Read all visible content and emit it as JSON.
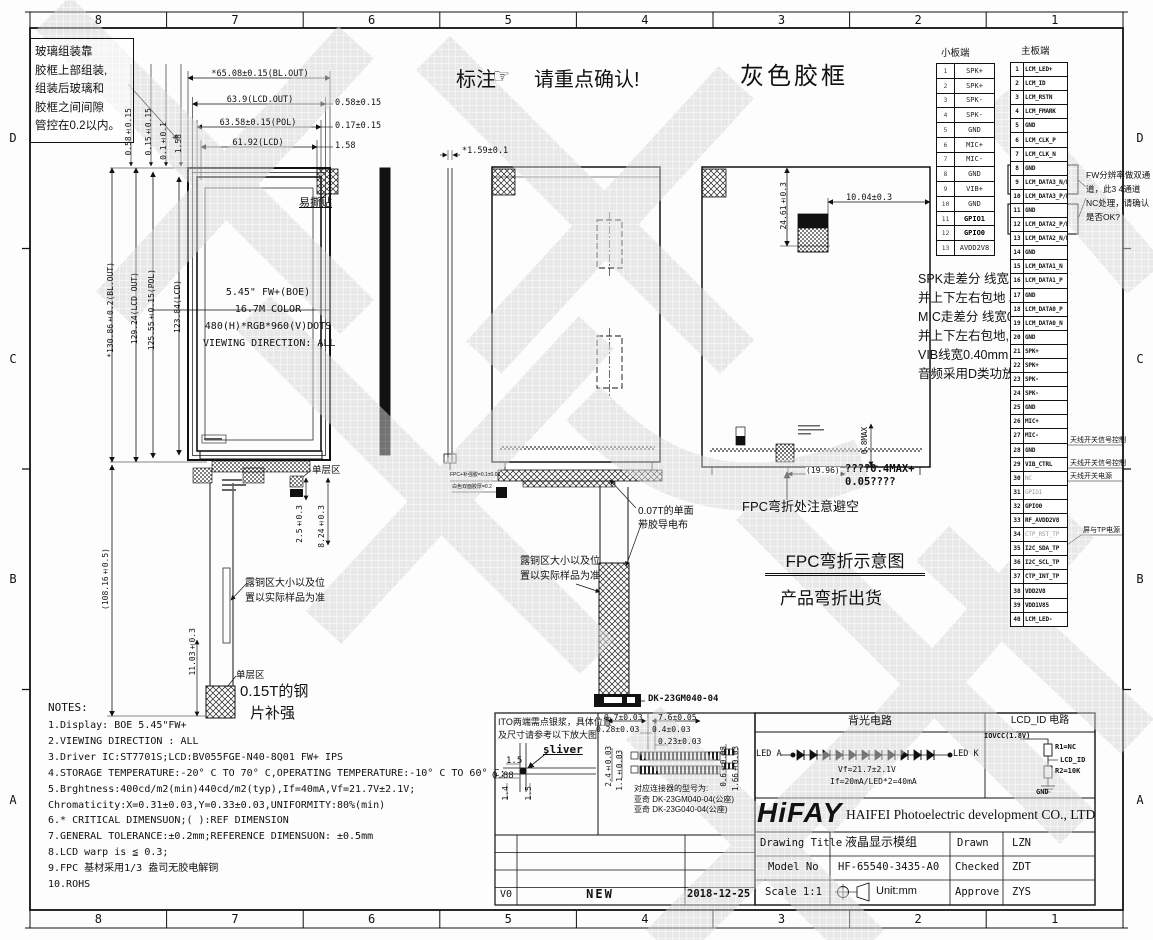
{
  "colors": {
    "line": "#111111",
    "watermark": "#d4d4d4"
  },
  "border": {
    "cols": [
      "8",
      "7",
      "6",
      "5",
      "4",
      "3",
      "2",
      "1"
    ],
    "rows": [
      "D",
      "C",
      "B",
      "A"
    ]
  },
  "header": {
    "glass_note_lines": [
      "玻璃组装靠",
      "胶框上部组装,",
      "组装后玻璃和",
      "胶框之间间隙",
      "管控在0.2以内。"
    ],
    "annotation_label": "标注",
    "hand_icon": "☞",
    "confirm_label": "请重点确认!",
    "gray_frame_label": "灰色胶框"
  },
  "front_view": {
    "dims_top": [
      "*65.08±0.15(BL.OUT)",
      "63.9(LCD.OUT)",
      "63.58±0.15(POL)",
      "61.92(LCD)"
    ],
    "dims_top_right": [
      "0.58±0.15",
      "0.17±0.15",
      "1.58"
    ],
    "dims_top_small": [
      "0.58±0.15",
      "0.15±0.15",
      "0.1±0.1",
      "1.58"
    ],
    "dims_left": [
      "*130.86±0.2(BL.OUT)",
      "129.24(LCD OUT)",
      "125.55±0.15(POL)",
      "123.84(LCD)"
    ],
    "easy_tear_label": "易撕贴",
    "panel_lines": [
      "5.45\" FW+(BOE)",
      "16.7M COLOR",
      "480(H)*RGB*960(V)DOTS",
      "VIEWING DIRECTION: ALL"
    ],
    "dim_tail_total": "(108.16±0.5)",
    "dim_tail_1": "2.5±0.3",
    "dim_tail_2": "8.24±0.3",
    "dim_tail_3": "11.03±0.3",
    "single_layer_label_1": "单层区",
    "single_layer_label_2": "单层区",
    "copper_note_lines": [
      "露铜区大小以及位",
      "置以实际样品为准"
    ],
    "steel_note_line1": "0.15T的钢",
    "steel_note_line2": "片补强"
  },
  "side_view": {
    "dim_thickness": "*1.59±0.1"
  },
  "back_view": {
    "cloth_note_lines": [
      "0.07T的单面",
      "带胶导电布"
    ],
    "copper_note_lines": [
      "露铜区大小以及位",
      "置以实际样品为准"
    ],
    "stack_note_line1": "FPC+补强胶=0.1±0.03",
    "stack_note_line2": "白色双面胶厚=0.2",
    "connector_label": "DK-23GM040-04"
  },
  "frame_view": {
    "dim_height": "24.61±0.3",
    "dim_width": "10.04±0.3",
    "dim_gap": "(19.96)",
    "dim_max": "0.8MAX",
    "foam_note_line1": "????0.4MAX+",
    "foam_note_line2": "0.05????",
    "bend_note": "FPC弯折处注意避空",
    "bend_title": "FPC弯折示意图",
    "bend_subtitle": "产品弯折出货"
  },
  "small_board": {
    "title": "小板端",
    "rows": [
      {
        "pin": "1",
        "signal": "SPK+"
      },
      {
        "pin": "2",
        "signal": "SPK+"
      },
      {
        "pin": "3",
        "signal": "SPK-"
      },
      {
        "pin": "4",
        "signal": "SPK-"
      },
      {
        "pin": "5",
        "signal": "GND"
      },
      {
        "pin": "6",
        "signal": "MIC+"
      },
      {
        "pin": "7",
        "signal": "MIC-"
      },
      {
        "pin": "8",
        "signal": "GND"
      },
      {
        "pin": "9",
        "signal": "VIB+"
      },
      {
        "pin": "10",
        "signal": "GND"
      },
      {
        "pin": "11",
        "signal": "GPIO1"
      },
      {
        "pin": "12",
        "signal": "GPIO0"
      },
      {
        "pin": "13",
        "signal": "AVDD2V8"
      }
    ]
  },
  "main_board": {
    "title": "主板端",
    "rows": [
      {
        "pin": "1",
        "signal": "LCM_LED+"
      },
      {
        "pin": "2",
        "signal": "LCM_ID"
      },
      {
        "pin": "3",
        "signal": "LCM_RSTN"
      },
      {
        "pin": "4",
        "signal": "LCM_FMARK"
      },
      {
        "pin": "5",
        "signal": "GND"
      },
      {
        "pin": "6",
        "signal": "LCM_CLK_P"
      },
      {
        "pin": "7",
        "signal": "LCM_CLK_N"
      },
      {
        "pin": "8",
        "signal": "GND"
      },
      {
        "pin": "9",
        "signal": "LCM_DATA3_N/NC"
      },
      {
        "pin": "10",
        "signal": "LCM_DATA3_P/NC"
      },
      {
        "pin": "11",
        "signal": "GND"
      },
      {
        "pin": "12",
        "signal": "LCM_DATA2_P/NC"
      },
      {
        "pin": "13",
        "signal": "LCM_DATA2_N/NC"
      },
      {
        "pin": "14",
        "signal": "GND"
      },
      {
        "pin": "15",
        "signal": "LCM_DATA1_N"
      },
      {
        "pin": "16",
        "signal": "LCM_DATA1_P"
      },
      {
        "pin": "17",
        "signal": "GND"
      },
      {
        "pin": "18",
        "signal": "LCM_DATA0_P"
      },
      {
        "pin": "19",
        "signal": "LCM_DATA0_N"
      },
      {
        "pin": "20",
        "signal": "GND"
      },
      {
        "pin": "21",
        "signal": "SPK+"
      },
      {
        "pin": "22",
        "signal": "SPK+"
      },
      {
        "pin": "23",
        "signal": "SPK-"
      },
      {
        "pin": "24",
        "signal": "SPK-"
      },
      {
        "pin": "25",
        "signal": "GND"
      },
      {
        "pin": "26",
        "signal": "MIC+"
      },
      {
        "pin": "27",
        "signal": "MIC-"
      },
      {
        "pin": "28",
        "signal": "GND"
      },
      {
        "pin": "29",
        "signal": "VIB_CTRL"
      },
      {
        "pin": "30",
        "signal": "NC"
      },
      {
        "pin": "31",
        "signal": "GPIO1"
      },
      {
        "pin": "32",
        "signal": "GPIO0"
      },
      {
        "pin": "33",
        "signal": "RF_AVDD2V8"
      },
      {
        "pin": "34",
        "signal": "CTP_RST_TP"
      },
      {
        "pin": "35",
        "signal": "I2C_SDA_TP"
      },
      {
        "pin": "36",
        "signal": "I2C_SCL_TP"
      },
      {
        "pin": "37",
        "signal": "CTP_INT_TP"
      },
      {
        "pin": "38",
        "signal": "VDD2V8"
      },
      {
        "pin": "39",
        "signal": "VDD1V85"
      },
      {
        "pin": "40",
        "signal": "LCM_LED-"
      }
    ]
  },
  "fw_note_lines": [
    "FW分辨率做双通",
    "道，此3 4通道",
    "NC处理，请确认",
    "是否OK?"
  ],
  "routing_note_lines": [
    "SPK走差分 线宽1.0mm",
    "并上下左右包地 。",
    "MIC走差分 线宽0.30mm",
    "并上下左右包地,",
    "VIB线宽0.40mm",
    "音频采用D类功放"
  ],
  "pin_notes": {
    "ant1": "天线开关信号控制",
    "ant2": "天线开关信号控制",
    "ant_pwr": "天线开关电源",
    "tp_pwr": "屏与TP电源"
  },
  "notes": {
    "title": "NOTES:",
    "lines": [
      "1.Display: BOE 5.45\"FW+",
      "2.VIEWING DIRECTION : ALL",
      "3.Driver IC:ST7701S;LCD:BV055FGE-N40-8Q01 FW+ IPS",
      "4.STORAGE TEMPERATURE:-20° C TO 70° C,OPERATING TEMPERATURE:-10° C TO 60° C;",
      "5.Brghtness:400cd/m2(min)440cd/m2(typ),If=40mA,Vf=21.7V±2.1V;",
      " Chromaticity:X=0.31±0.03,Y=0.33±0.03,UNIFORMITY:80%(min)",
      "6.* CRITICAL DIMENSUON;( ):REF DIMENSION",
      "7.GENERAL TOLERANCE:±0.2mm;REFERENCE DIMENSUON: ±0.5mm",
      "8.LCD warp is ≦ 0.3;",
      "9.FPC 基材采用1/3 盎司无胶电解铜",
      "10.ROHS"
    ]
  },
  "ito_detail": {
    "note_lines": [
      "ITO两端需点银浆，具体位置",
      "及尺寸请参考以下放大图:"
    ],
    "sliver_label": "sliver",
    "dim1": "1.5",
    "dim2": "0.88",
    "dim3": "1.4",
    "dim4": "1.5"
  },
  "connector_detail": {
    "dims": [
      "0.7±0.03",
      "7.6±0.05",
      "0.28±0.03",
      "0.4±0.03",
      "0.23±0.03"
    ],
    "dims_v": [
      "2.4±0.03",
      "1.1±0.03",
      "0.6±0.03",
      "1.66±0.03"
    ],
    "note_lines": [
      "对应连接器的型号为:",
      "亚奇 DK-23GM040-04(公座)",
      "亚奇 DK-23G040-04(公座)"
    ]
  },
  "revision": {
    "rev": "V0",
    "desc": "NEW",
    "date": "2018-12-25"
  },
  "title_block": {
    "backlight_header": "背光电路",
    "lcdid_header": "LCD_ID 电路",
    "led_a": "LED A",
    "led_k": "LED K",
    "vf": "Vf=21.7±2.1V",
    "if_line": "If=20mA/LED*2=40mA",
    "iovcc": "IOVCC(1.8V)",
    "r1": "R1=NC",
    "lcd_id": "LCD_ID",
    "r2": "R2=10K",
    "gnd": "GND",
    "logo": "HiFAY",
    "company": "HAIFEI Photoelectric development CO., LTD",
    "drawing_title_label": "Drawing Title",
    "drawing_title": "液晶显示模组",
    "drawn_label": "Drawn",
    "drawn": "LZN",
    "model_label": "Model No",
    "model": "HF-65540-3435-A0",
    "checked_label": "Checked",
    "checked": "ZDT",
    "scale_label": "Scale 1:1",
    "unit": "Unit:mm",
    "approve_label": "Approve",
    "approve": "ZYS"
  }
}
